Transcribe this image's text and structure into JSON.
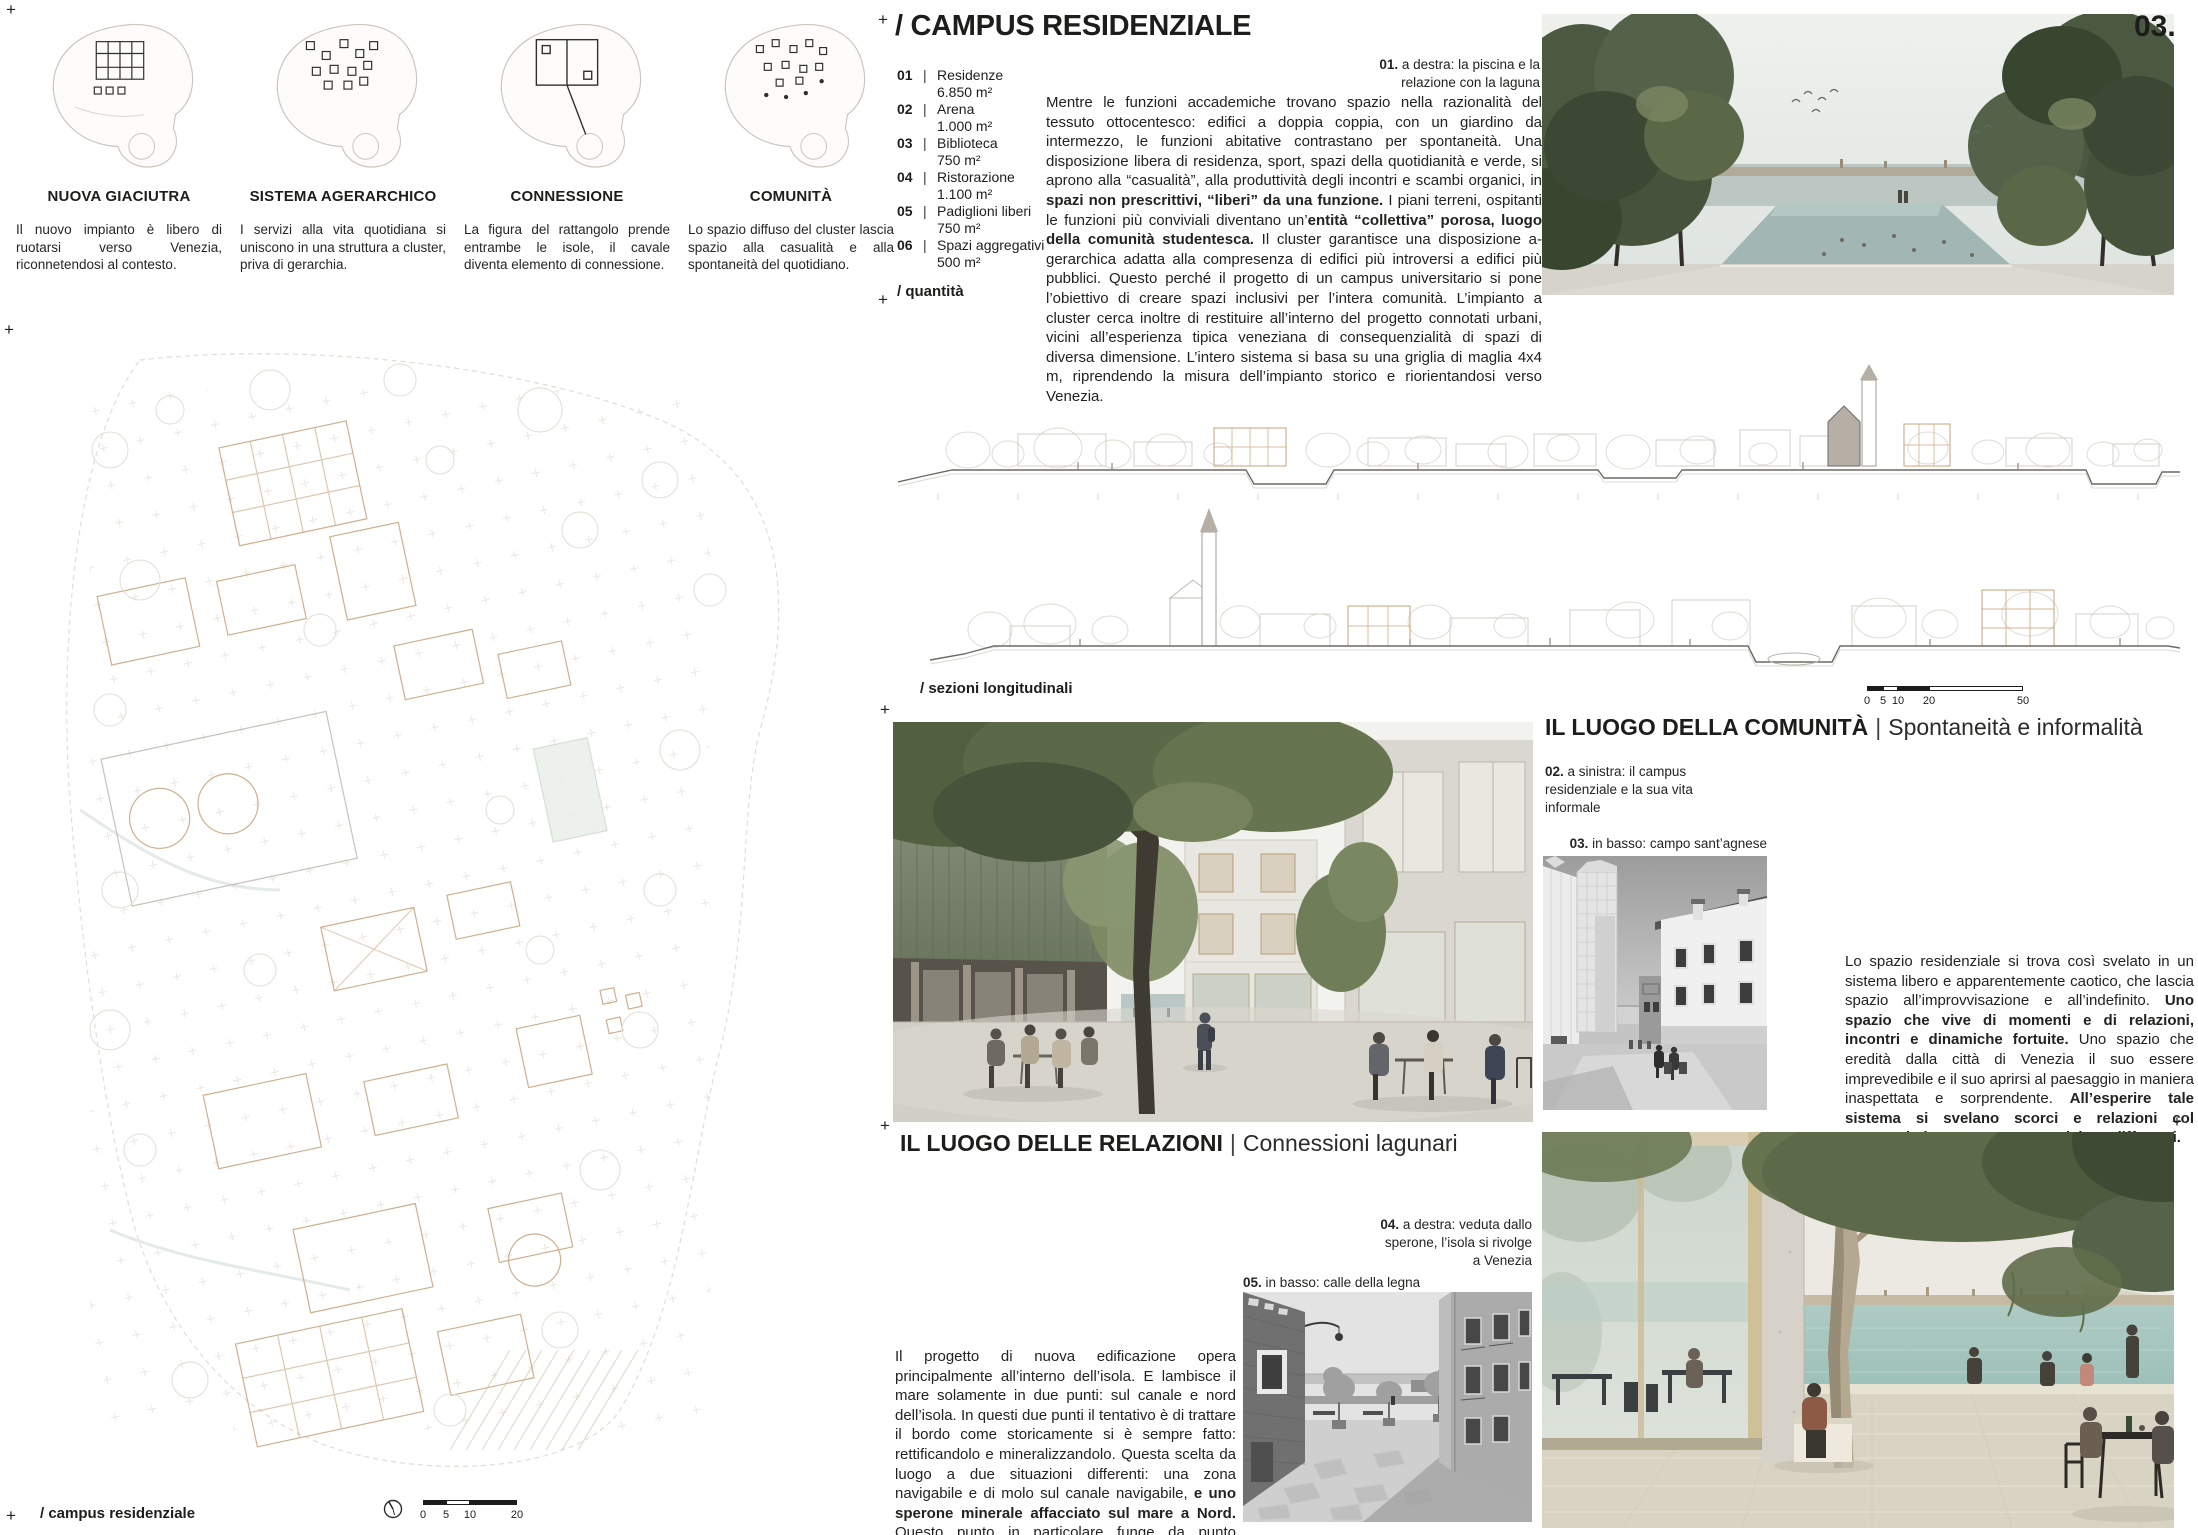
{
  "page": {
    "number": "03.",
    "plus_mark": "+"
  },
  "colors": {
    "text": "#1d1d1b",
    "tan_accent": "#c8a077",
    "section_line": "#6e6a64",
    "lagoon_teal": "#a9c9c2",
    "foliage_green": "#55624a"
  },
  "concepts": {
    "items": [
      {
        "title": "NUOVA GIACIUTRA",
        "text": "Il nuovo impianto è libero di ruotarsi verso Venezia, riconnetendosi al contesto."
      },
      {
        "title": "SISTEMA AGERARCHICO",
        "text": "I servizi alla vita quotidiana si uniscono in una struttura a cluster, priva di gerarchia."
      },
      {
        "title": "CONNESSIONE",
        "text": "La figura del rattangolo prende entrambe le isole, il cavale diventa elemento di connessione."
      },
      {
        "title": "COMUNITÀ",
        "text": "Lo spazio diffuso del cluster lascia spazio alla casualità e alla spontaneità del quotidiano."
      }
    ]
  },
  "header": {
    "title": "/ CAMPUS RESIDENZIALE"
  },
  "program": {
    "sep": "|",
    "label": "/ quantità",
    "items": [
      {
        "num": "01",
        "name": "Residenze",
        "area": "6.850 m²"
      },
      {
        "num": "02",
        "name": "Arena",
        "area": "1.000 m²"
      },
      {
        "num": "03",
        "name": "Biblioteca",
        "area": "750 m²"
      },
      {
        "num": "04",
        "name": "Ristorazione",
        "area": "1.100 m²"
      },
      {
        "num": "05",
        "name": "Padiglioni liberi",
        "area": "750 m²"
      },
      {
        "num": "06",
        "name": "Spazi aggregativi",
        "area": "500 m²"
      }
    ]
  },
  "intro": {
    "caption": {
      "num": "01.",
      "text": "a destra: la piscina e la relazione con la laguna"
    },
    "runs": [
      {
        "t": "Mentre le funzioni accademiche trovano spazio nella razionalità del tessuto ottocentesco: edifici a doppia coppia, con un giardino da intermezzo, le funzioni abitative contrastano per spontaneità. Una disposizione libera di residenza, sport, spazi della quotidianità e verde, si aprono alla “casualità”, alla produttività degli incontri e scambi organici, in ",
        "b": false
      },
      {
        "t": "spazi non prescrittivi, “liberi” da una funzione.",
        "b": true
      },
      {
        "t": " I piani terreni, ospitanti le funzioni più conviviali diventano un’",
        "b": false
      },
      {
        "t": "entità “collettiva” porosa, luogo della comunità studentesca.",
        "b": true
      },
      {
        "t": " Il cluster garantisce una disposizione a-gerarchica adatta alla compresenza di edifici più introversi a edifici più pubblici. Questo perché il progetto di un campus universitario si pone l’obiettivo di creare spazi inclusivi per l’intera comunità. L’impianto a cluster cerca inoltre di restituire all’interno del progetto connotati urbani, vicini all’esperienza tipica veneziana di consequenzialità di spazi di diversa dimensione. L’intero sistema si basa su una griglia di maglia 4x4 m, riprendendo la misura dell’impianto storico e riorientandosi verso Venezia.",
        "b": false
      }
    ]
  },
  "sections": {
    "label": "/ sezioni longitudinali",
    "scale": {
      "ticks": [
        "0",
        "5",
        "10",
        "20",
        "50"
      ]
    }
  },
  "plan": {
    "label": "/ campus residenziale",
    "scale": {
      "ticks": [
        "0",
        "5",
        "10",
        "20"
      ]
    }
  },
  "community": {
    "title": {
      "bold": "IL LUOGO DELLA COMUNITÀ",
      "sep": "|",
      "light": "Spontaneità e informalità"
    },
    "caption_campus": {
      "num": "02.",
      "text": "a sinistra: il campus residenziale e la sua vita informale"
    },
    "caption_campo": {
      "num": "03.",
      "text": "in basso: campo sant’agnese"
    },
    "runs": [
      {
        "t": "Lo spazio residenziale si trova così svelato in un sistema libero e apparentemente caotico, che lascia spazio all’improvvisazione e all’indefinito. ",
        "b": false
      },
      {
        "t": "Uno spazio che vive di momenti e di relazioni, incontri e dinamiche fortuite.",
        "b": true
      },
      {
        "t": " Uno spazio che eredità dalla città di Venezia il suo essere imprevedibile e il suo aprirsi al paesaggio in maniera inaspettata e sorprendente. ",
        "b": false
      },
      {
        "t": "All’esperire tale sistema si svelano scorci e relazioni col paesaggio lagunare sempre uniche e differenti.",
        "b": true
      }
    ]
  },
  "relations": {
    "title": {
      "bold": "IL LUOGO DELLE RELAZIONI",
      "sep": "|",
      "light": "Connessioni lagunari"
    },
    "caption_sperone": {
      "num": "04.",
      "text": "a destra: veduta dallo sperone, l’isola si rivolge a Venezia"
    },
    "caption_calle": {
      "num": "05.",
      "text": "in basso: calle della legna"
    },
    "runs": [
      {
        "t": "Il progetto di nuova edificazione opera principalmente all’interno dell’isola. E lambisce il mare solamente in due punti: sul canale e nord dell’isola. In questi due punti il tentativo è di trattare il bordo come storicamente si è sempre fatto: rettificandolo e mineralizzandolo. Questa scelta da luogo a due situazioni differenti: una zona navigabile e di molo sul canale navigabile, ",
        "b": false
      },
      {
        "t": "e uno sperone minerale affacciato sul mare a Nord.",
        "b": true
      },
      {
        "t": " Questo punto in particolare funge da punto terminale del progetto, e ",
        "b": false
      },
      {
        "t": "rivolgendosi a Venezia disvela in fine progettuale di riconnessione con la città.",
        "b": true
      }
    ]
  }
}
